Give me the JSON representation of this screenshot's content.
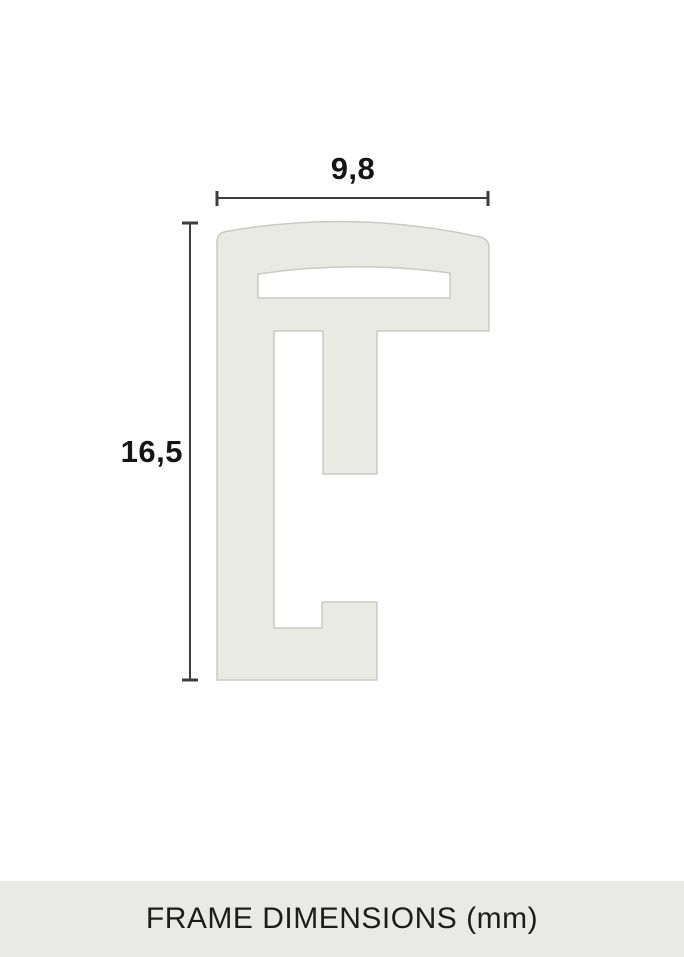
{
  "diagram": {
    "width_label": "9,8",
    "height_label": "16,5",
    "caption": "FRAME DIMENSIONS (mm)"
  },
  "colors": {
    "background": "#ffffff",
    "profile_fill": "#e9eae4",
    "profile_stroke": "#c8cac4",
    "dimension_line": "#3d3d3d",
    "label_text": "#151515",
    "caption_band": "#e9e9e5",
    "caption_text": "#1d1d1b"
  }
}
